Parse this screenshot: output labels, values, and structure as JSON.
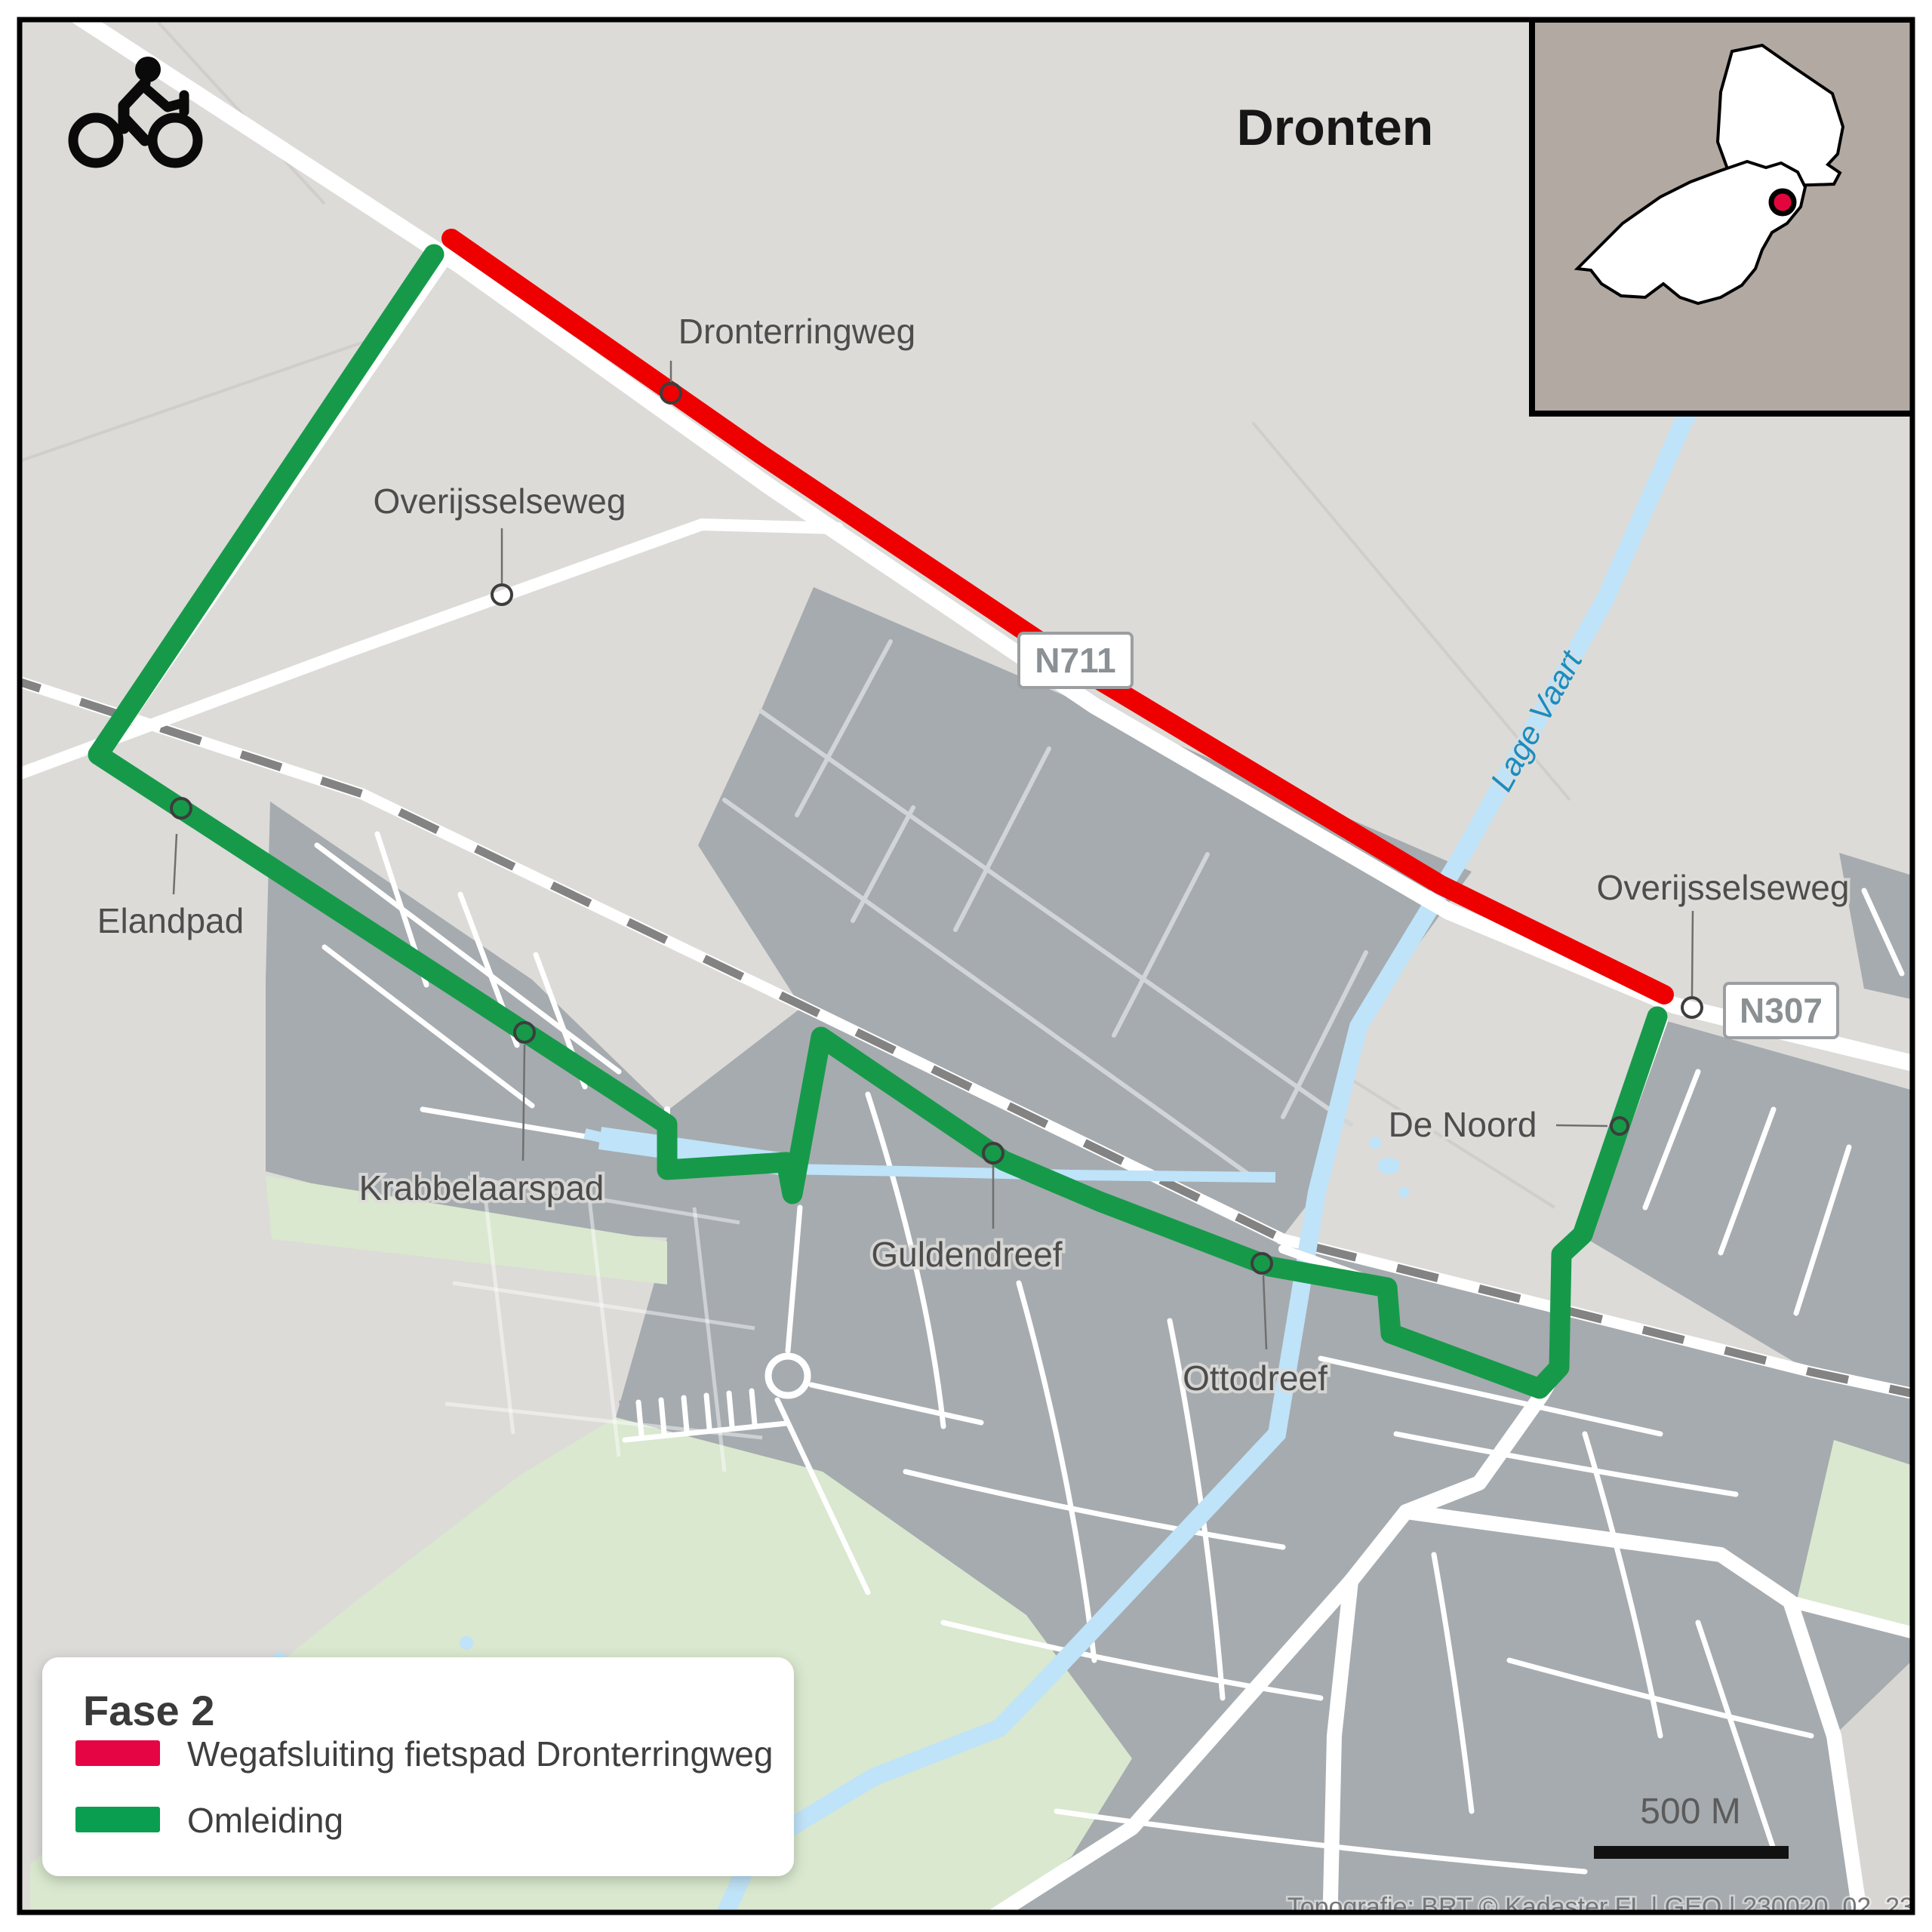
{
  "title": "Dronten",
  "map_labels": {
    "dronterringweg": "Dronterringweg",
    "overijsselseweg_west": "Overijsselseweg",
    "elandpad": "Elandpad",
    "krabbelaarspad": "Krabbelaarspad",
    "guldendreef": "Guldendreef",
    "ottodreef": "Ottodreef",
    "de_noord": "De Noord",
    "overijsselseweg_east": "Overijsselseweg",
    "lage_vaart": "Lage Vaart"
  },
  "route_badges": {
    "n711": "N711",
    "n307": "N307"
  },
  "legend": {
    "title": "Fase 2",
    "items": [
      {
        "label": "Wegafsluiting fietspad Dronterringweg",
        "color": "#e50544"
      },
      {
        "label": "Omleiding",
        "color": "#0a9e50"
      }
    ]
  },
  "routes": {
    "closure_color": "#ee0000",
    "detour_color": "#169a4a"
  },
  "scale_bar": {
    "label": "500 M"
  },
  "attribution": "Topografie: BRT © Kadaster  FL | GEO | 230020_02_23",
  "icons": {
    "cyclist": "cyclist-icon",
    "inset": "locator-inset-map"
  }
}
